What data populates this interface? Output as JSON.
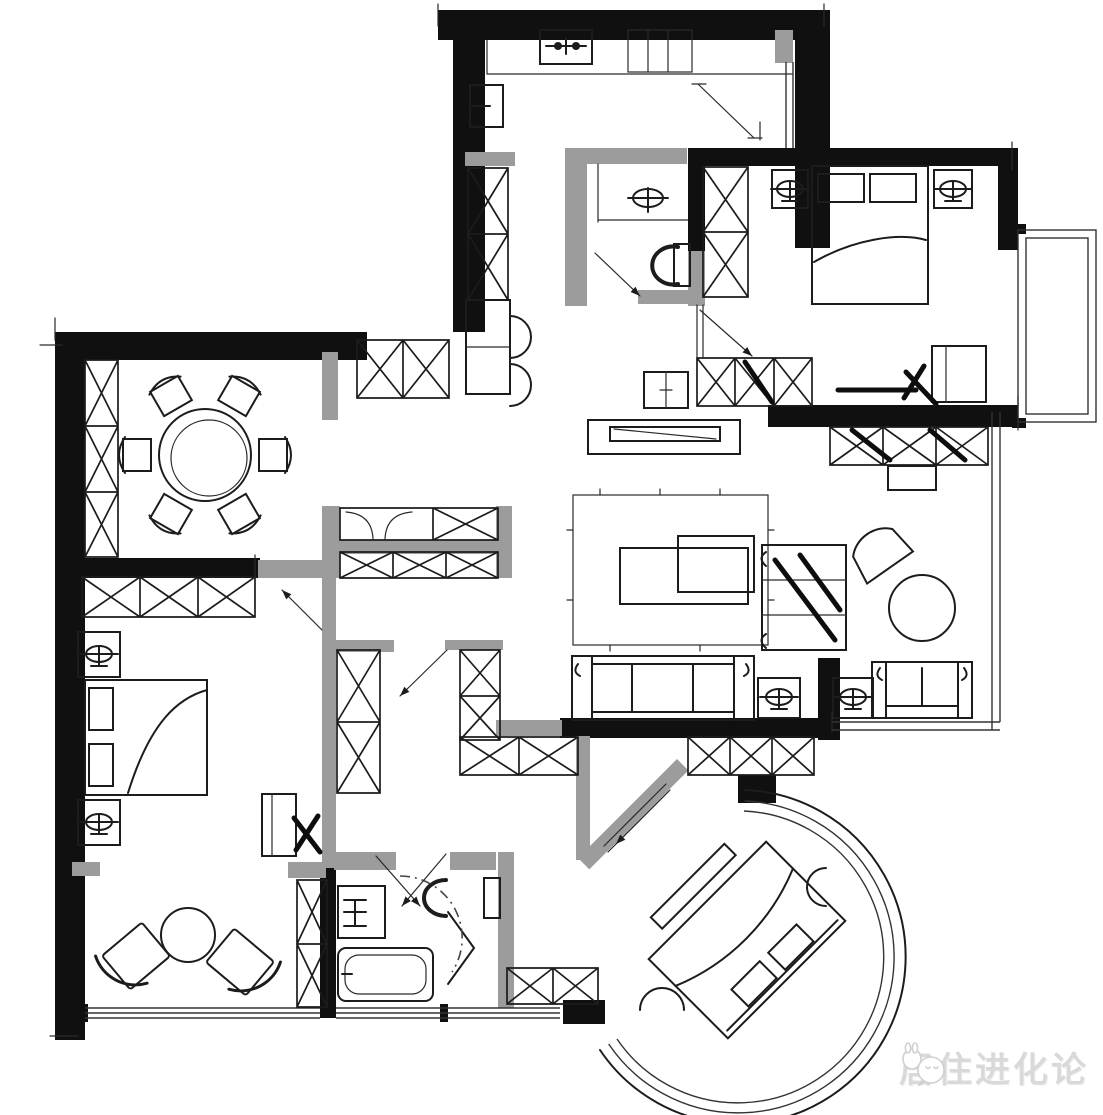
{
  "document": {
    "type": "hand-drawn apartment floor plan sketch",
    "style": "black ink and gray partitions on white paper, no dimension text"
  },
  "watermark": {
    "icon": "wechat-chat-bubbles-icon",
    "text": "居住进化论",
    "color": "#d9d9d9"
  },
  "palette": {
    "background": "#ffffff",
    "wall_black": "#101010",
    "partition_gray": "#9c9c9c",
    "ink": "#1c1c1c",
    "watermark_gray": "#d9d9d9"
  },
  "plan": {
    "rooms": [
      {
        "id": "dining-room",
        "symbols": [
          "round-dining-table",
          "six-dining-chairs",
          "tall-side-cabinet",
          "sideboard-row"
        ]
      },
      {
        "id": "kitchen",
        "symbols": [
          "counter",
          "double-basin-sink",
          "cooktop-box",
          "tall-cabinets",
          "refrigerator-with-door-swings"
        ]
      },
      {
        "id": "master-bedroom",
        "symbols": [
          "double-bed",
          "two-nightstands-with-lamps",
          "wardrobe-column",
          "desk-and-chair",
          "bay-window"
        ]
      },
      {
        "id": "ensuite-bathroom",
        "symbols": [
          "washbasin",
          "toilet",
          "door-swing"
        ]
      },
      {
        "id": "living-room",
        "symbols": [
          "tv-console",
          "area-rug",
          "nested-coffee-tables",
          "three-seat-sofa",
          "lamp-side-tables",
          "open-shelf-divider"
        ]
      },
      {
        "id": "sun-lounge",
        "symbols": [
          "fan-back-armchair",
          "round-table",
          "loveseat",
          "storage-row",
          "window-wall"
        ]
      },
      {
        "id": "bedroom-2",
        "symbols": [
          "double-bed",
          "two-nightstands-with-lamps",
          "wardrobe-row",
          "desk-and-chair"
        ]
      },
      {
        "id": "leisure-balcony",
        "symbols": [
          "two-angled-lounge-chairs",
          "round-tea-table",
          "window-band"
        ]
      },
      {
        "id": "bathroom-2",
        "symbols": [
          "vanity-basin",
          "bathtub",
          "toilet",
          "folding-shower-door",
          "door-swing-arrows"
        ]
      },
      {
        "id": "round-bay-bedroom",
        "symbols": [
          "diagonal-double-bed",
          "foot-bench",
          "pouf",
          "triple-arc-curved-window",
          "diagonal-sliding-door"
        ]
      },
      {
        "id": "hallway",
        "symbols": [
          "double-sided-cabinet-block",
          "shoe-bench",
          "tall-storage-columns",
          "door-swing-arrows"
        ]
      }
    ]
  }
}
